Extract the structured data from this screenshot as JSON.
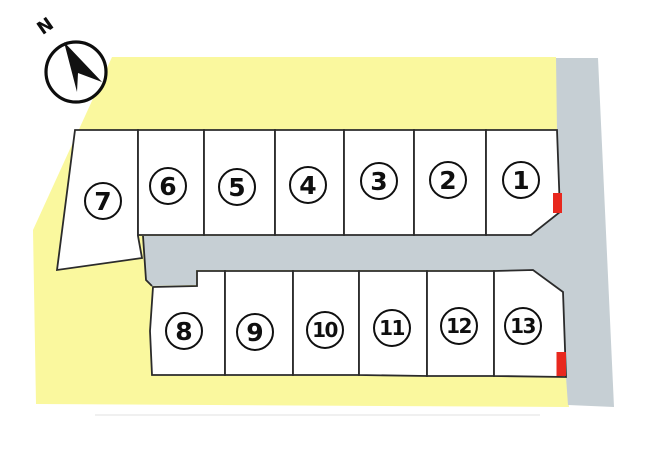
{
  "compass": {
    "label": "N"
  },
  "plots": [
    {
      "id": 1,
      "label": "1",
      "red_marker": true
    },
    {
      "id": 2,
      "label": "2",
      "red_marker": false
    },
    {
      "id": 3,
      "label": "3",
      "red_marker": false
    },
    {
      "id": 4,
      "label": "4",
      "red_marker": false
    },
    {
      "id": 5,
      "label": "5",
      "red_marker": false
    },
    {
      "id": 6,
      "label": "6",
      "red_marker": false
    },
    {
      "id": 7,
      "label": "7",
      "red_marker": false
    },
    {
      "id": 8,
      "label": "8",
      "red_marker": false
    },
    {
      "id": 9,
      "label": "9",
      "red_marker": false
    },
    {
      "id": 10,
      "label": "10",
      "red_marker": false
    },
    {
      "id": 11,
      "label": "11",
      "red_marker": false
    },
    {
      "id": 12,
      "label": "12",
      "red_marker": false
    },
    {
      "id": 13,
      "label": "13",
      "red_marker": true
    }
  ],
  "colors": {
    "site": "#faf89e",
    "road": "#c6cfd4",
    "plot_line": "#2b2b2b",
    "marker_red": "#e8281e"
  }
}
